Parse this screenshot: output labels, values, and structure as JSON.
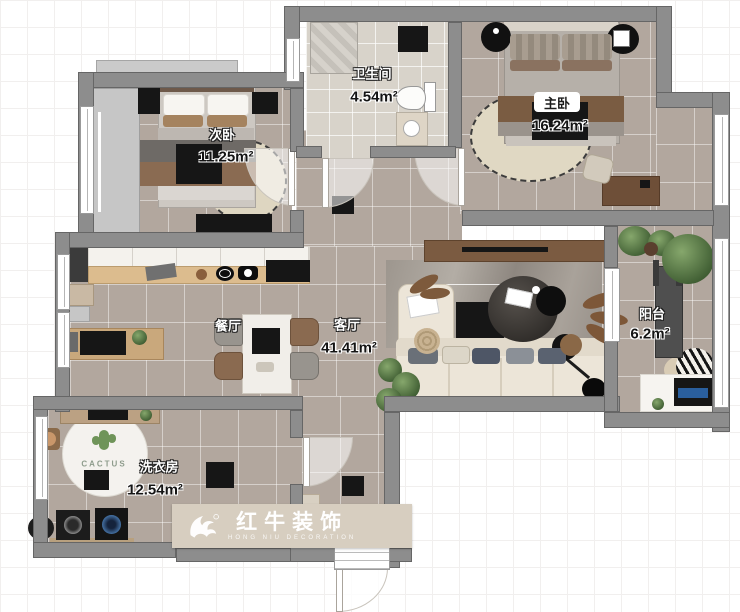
{
  "plan": {
    "rooms": [
      {
        "key": "second-bedroom",
        "label": "次卧",
        "area": "11.25m²"
      },
      {
        "key": "bathroom",
        "label": "卫生间",
        "area": "4.54m²"
      },
      {
        "key": "master-bedroom",
        "label": "主卧",
        "area": "16.24m²"
      },
      {
        "key": "dining",
        "label": "餐厅",
        "area": ""
      },
      {
        "key": "living",
        "label": "客厅",
        "area": "41.41m²"
      },
      {
        "key": "balcony",
        "label": "阳台",
        "area": "6.2m²"
      },
      {
        "key": "laundry",
        "label": "洗衣房",
        "area": "12.54m²"
      }
    ],
    "rug_text": "CACTUS",
    "watermark": {
      "brand": "红牛装饰",
      "subtitle": "HONG NIU DECORATION"
    }
  }
}
